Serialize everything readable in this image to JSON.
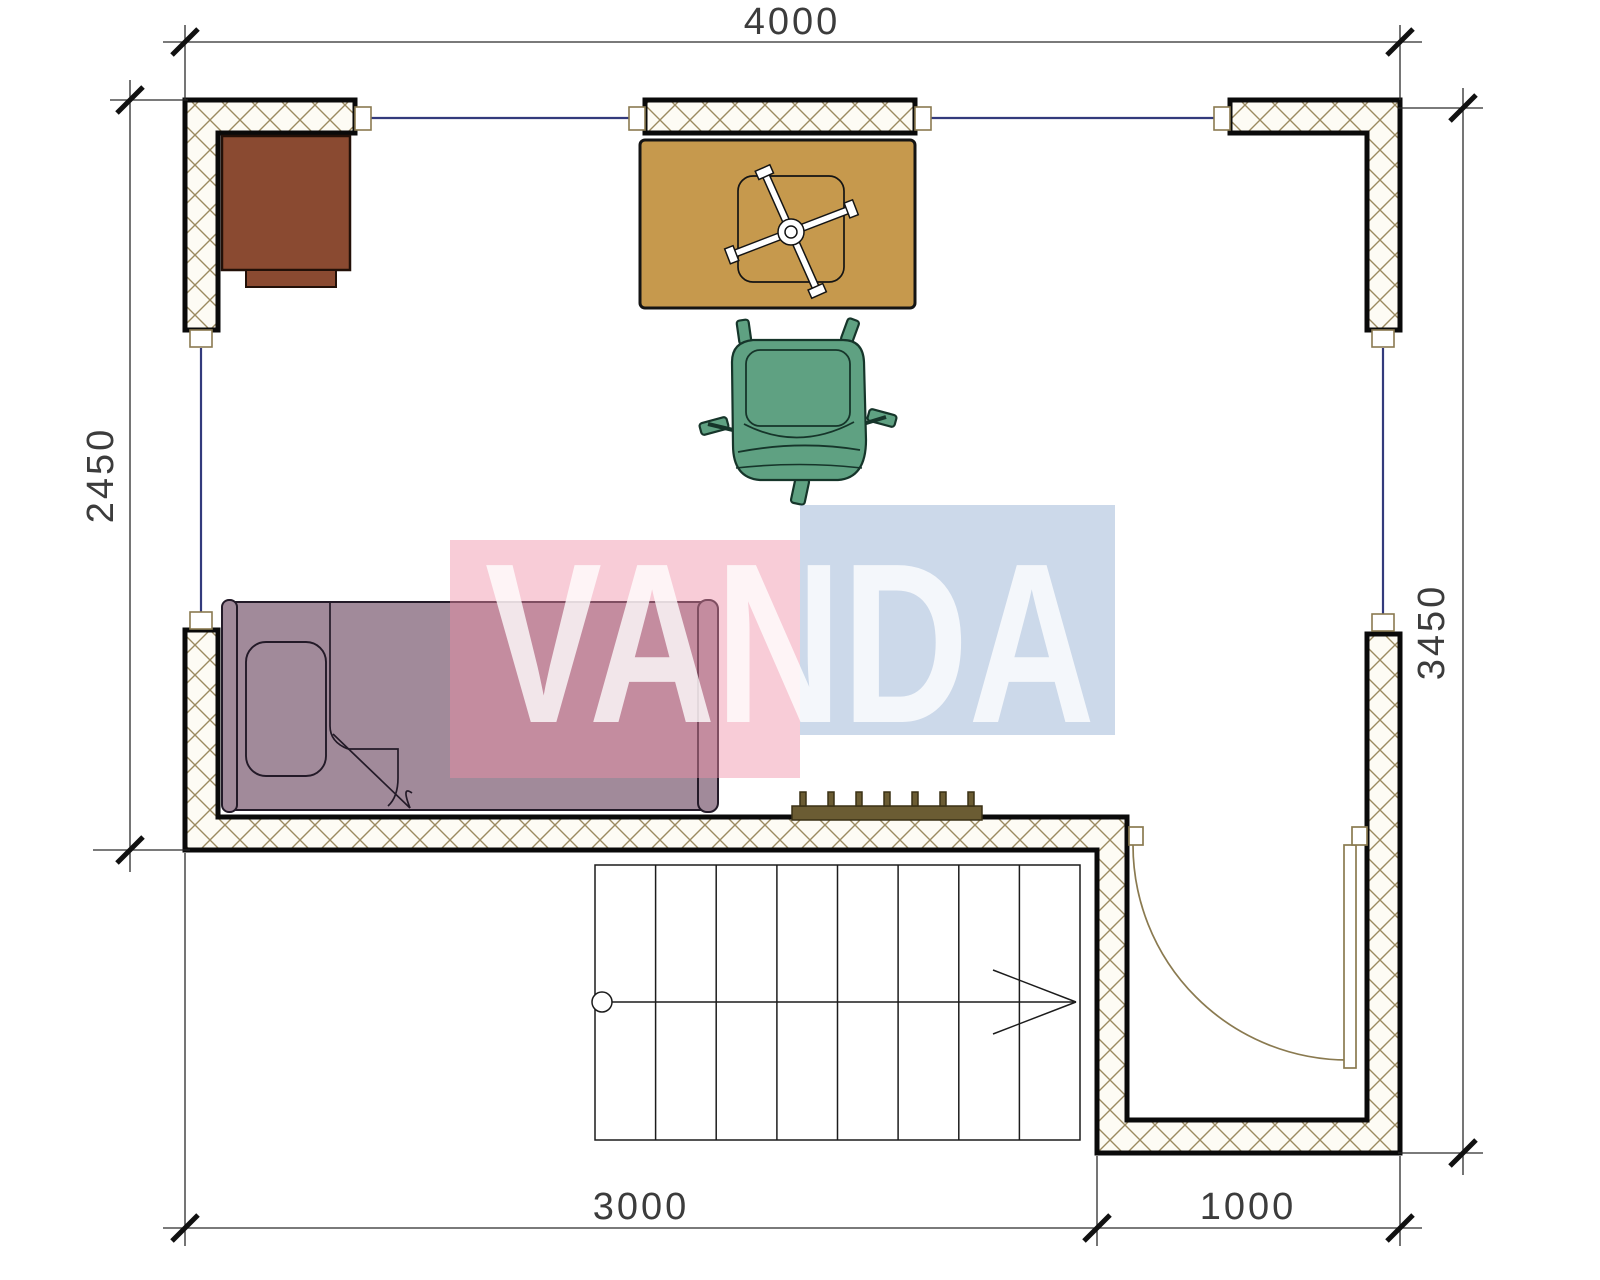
{
  "plan": {
    "dimensions": {
      "top": "4000",
      "left": "2450",
      "right": "3450",
      "bottom_left": "3000",
      "bottom_right": "1000"
    },
    "stairs": {
      "treads": 8,
      "walk_direction": "right"
    },
    "furniture": [
      "desk",
      "table",
      "office-chair",
      "bed",
      "radiator",
      "stairs",
      "door"
    ],
    "colors": {
      "wall_outline": "#0a0a0a",
      "wall_hatch_line": "#9b8a60",
      "wall_hatch_bg": "#fdfbf4",
      "window_line": "#333a7c",
      "desk": "#8a4a31",
      "table": "#c6994d",
      "chair": "#5fa182",
      "bed": "#a18a9a",
      "radiator": "#6b5c33",
      "door": "#8a7a50"
    }
  },
  "watermark": {
    "text": "VANDA",
    "pink": "#ef8ea6",
    "blue": "#8fabd1"
  }
}
